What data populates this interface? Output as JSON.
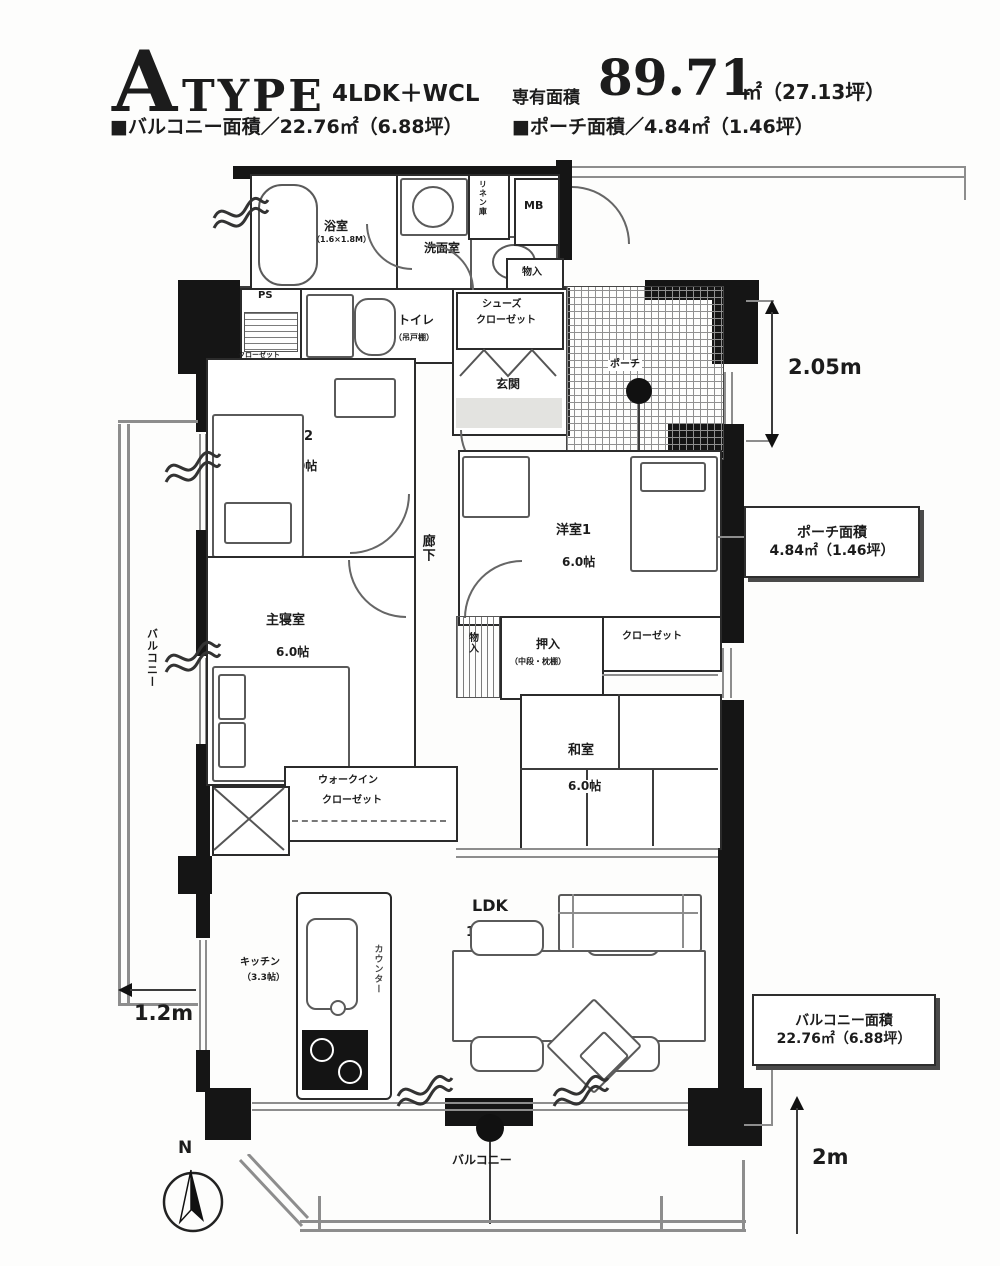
{
  "header": {
    "type_letter": "A",
    "type_word": "TYPE",
    "layout": "4LDK＋WCL",
    "area_label": "専有面積",
    "area_value": "89.71",
    "area_suffix": "㎡（27.13坪）",
    "balcony_area_line": "■バルコニー面積／22.76㎡（6.88坪）",
    "porch_area_line": "■ポーチ面積／4.84㎡（1.46坪）"
  },
  "rooms": {
    "bath": {
      "name": "浴室",
      "size": "（1.6×1.8M）"
    },
    "washroom": {
      "name": "洗面室"
    },
    "linen": {
      "name": "リネン庫"
    },
    "meter_box": {
      "name": "MB"
    },
    "pipe_space": {
      "name": "PS"
    },
    "toilet": {
      "name": "トイレ",
      "note": "（吊戸棚）"
    },
    "shoes_closet": {
      "line1": "シューズ",
      "line2": "クローゼット"
    },
    "entrance": {
      "name": "玄関"
    },
    "entrance_storage": {
      "name": "物入"
    },
    "porch": {
      "name": "ポーチ"
    },
    "bedroom2": {
      "name": "洋室2",
      "size": "5.0帖"
    },
    "bedroom2_closet": {
      "name": "クローゼット"
    },
    "hallway": {
      "name": "廊下"
    },
    "bedroom1": {
      "name": "洋室1",
      "size": "6.0帖"
    },
    "master_bedroom": {
      "name": "主寝室",
      "size": "6.0帖"
    },
    "walk_in_closet": {
      "line1": "ウォークイン",
      "line2": "クローゼット"
    },
    "mid_storage": {
      "name": "物入"
    },
    "oshiire": {
      "name": "押入",
      "note": "（中段・枕棚）"
    },
    "bedroom1_closet": {
      "name": "クローゼット"
    },
    "japanese_room": {
      "name": "和室",
      "size": "6.0帖"
    },
    "ldk": {
      "name": "LDK",
      "size": "16.6帖"
    },
    "kitchen": {
      "name": "キッチン",
      "size": "（3.3帖）"
    },
    "kitchen_counter": {
      "name": "カウンター"
    },
    "balcony_south": {
      "name": "バルコニー"
    },
    "balcony_west": {
      "name": "バルコニー"
    }
  },
  "dimensions": {
    "porch_depth": "2.05m",
    "balcony_west_width": "1.2m",
    "balcony_south_depth": "2m"
  },
  "callouts": {
    "porch": {
      "title": "ポーチ面積",
      "value": "4.84㎡（1.46坪）"
    },
    "balcony": {
      "title": "バルコニー面積",
      "value": "22.76㎡（6.88坪）"
    }
  },
  "compass": {
    "label": "N"
  },
  "colors": {
    "wall": "#151515",
    "paper": "#ffffff",
    "hatch": "#8f8f8f"
  }
}
